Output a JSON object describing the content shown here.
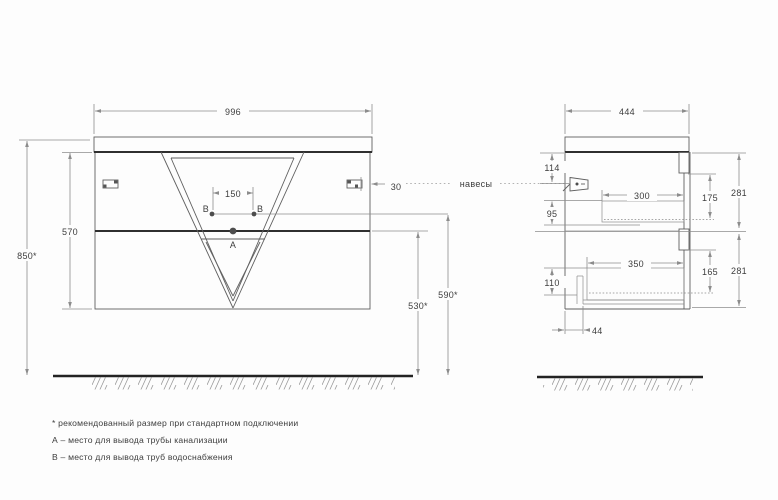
{
  "front": {
    "width": "996",
    "total_height": "850*",
    "body_height": "570",
    "holes_spacing": "150",
    "hole_b": "B",
    "hole_a": "A",
    "bracket_offset": "30",
    "drain_line_height": "530*",
    "supply_line_height": "590*"
  },
  "side": {
    "depth": "444",
    "hanger_top_offset": "114",
    "drawer1_inner_height": "95",
    "drawer2_inner_height": "110",
    "drawer1_inner_depth": "300",
    "drawer2_inner_depth": "350",
    "drawer1_front_height": "175",
    "drawer2_front_height": "165",
    "section1_height": "281",
    "section2_height": "281",
    "drain_offset": "44"
  },
  "labels": {
    "hangers": "навесы"
  },
  "notes": {
    "asterisk": "* рекомендованный размер при стандартном подключении",
    "a": "А – место для вывода трубы канализации",
    "b": "В – место для вывода труб водоснабжения"
  },
  "colors": {
    "background": "#fdfdfd",
    "outline": "#5f5f5f",
    "heavy_line": "#2f2f2f",
    "dimension": "#8c8c8c",
    "text": "#3d3d3d"
  }
}
